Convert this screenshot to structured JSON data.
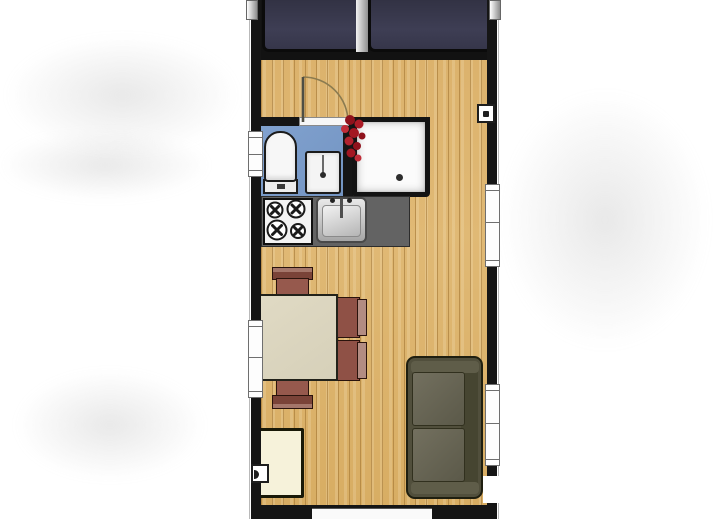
{
  "document": {
    "type": "floor-plan",
    "description": "Top-down architectural floor plan of a narrow cabin / mobile home",
    "visible_text": []
  },
  "colors": {
    "background": "#ffffff",
    "wall": "#151515",
    "wood_floor": "#ddb470",
    "bathroom_floor": "#7b9cc9",
    "bed": "#3a3a50",
    "countertop": "#636363",
    "table": "#dcd6bf",
    "chair_seat": "#96594d",
    "chair_back": "#7a4338",
    "sofa": "#514f3c",
    "cabinet": "#f6f2da",
    "accent_red": "#a81722",
    "fixture_white": "#f7f7f7"
  },
  "rooms": [
    {
      "name": "sleeping-area",
      "furniture": [
        "bed-left",
        "bed-right"
      ]
    },
    {
      "name": "bathroom",
      "furniture": [
        "toilet",
        "washbasin",
        "shower",
        "towel-hooks"
      ]
    },
    {
      "name": "kitchen",
      "furniture": [
        "countertop",
        "stove-four-burners",
        "kitchen-sink"
      ]
    },
    {
      "name": "living-dining",
      "furniture": [
        "dining-table",
        "chair-top",
        "chair-bottom",
        "chair-right-upper",
        "chair-right-lower",
        "sofa",
        "cabinet"
      ]
    }
  ],
  "openings": {
    "doors": [
      "bathroom-door-with-swing-arc",
      "bottom-wall-opening",
      "right-wall-lower-opening"
    ],
    "windows": [
      "left-window-upper",
      "left-window-lower",
      "right-window-upper",
      "right-window-lower"
    ]
  },
  "labels": {
    "bed_left": "bed",
    "bed_right": "bed",
    "toilet": "toilet",
    "washbasin": "washbasin",
    "shower": "shower",
    "stove": "stove",
    "kitchen_sink": "kitchen sink",
    "table": "dining table",
    "sofa": "sofa",
    "cabinet": "cabinet"
  }
}
